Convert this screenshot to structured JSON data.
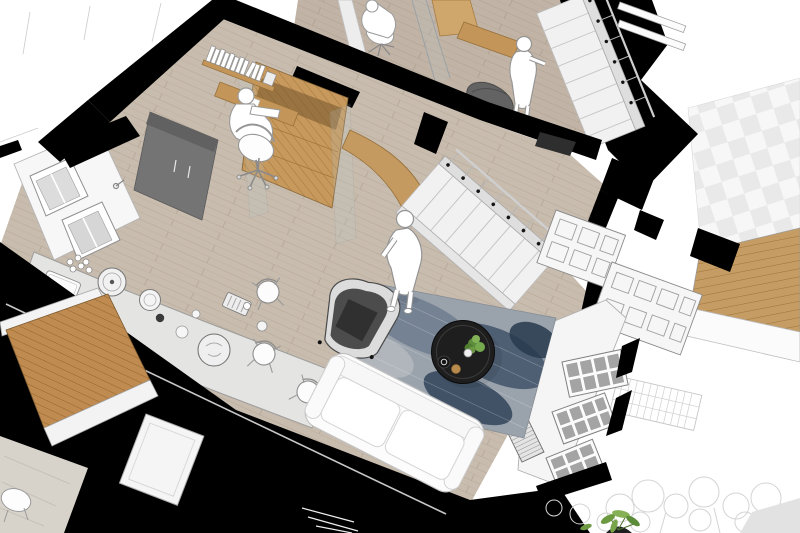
{
  "meta": {
    "label": "Aerial cutaway rendering of a split-level apartment interior, sketch style with black section-cut walls"
  },
  "palette": {
    "background": "#ffffff",
    "cut_walls": "#000000",
    "floor_wood": "#c8bcae",
    "stairwell_wood": "#c7995c",
    "deck_wood": "#bf8b50",
    "counter_gray": "#e4e4e2",
    "cabinet_gray": "#747474",
    "glass_pane_gray": "#a4a4a4",
    "rug_blue_gray": "#46586d",
    "armchair_gray": "#4c4c4c",
    "sofa_white": "#fcfcfc",
    "coffee_table_black": "#1e1e1e",
    "plant_green": "#76a84e",
    "figure_white": "#ffffff",
    "sketch_foliage": "#d4d4d4"
  },
  "scene": {
    "level_upper": [
      "wall desk with seated figure on task chair",
      "glass partition",
      "wood wet-room floor",
      "wall-mounted wood desk",
      "standing figure",
      "gray beanbag chair",
      "upper staircase with thin balusters",
      "white handrail bars over chimney cut"
    ],
    "kitchen": [
      "window wall with two white-framed windows",
      "faucet",
      "tall gray cabinet",
      "tiled gray wall with door",
      "long counter with sink",
      "pots, kettle, cups, dishes, round tray",
      "three dining chairs"
    ],
    "office_nook": [
      "bookshelf with white books",
      "wood desk",
      "seated figure on swivel chair"
    ],
    "stair_hall": [
      "wood-clad stairwell opening with glass balustrade",
      "curved wood panel",
      "main staircase with black baluster caps",
      "standing figure",
      "dark doormat"
    ],
    "living_room": [
      "blue distressed rug",
      "dark gray wingback armchair",
      "round black coffee table with potted plant, cup, bowl, pastry",
      "white two-seat sofa",
      "striped radiator",
      "bay window with gray glazing",
      "black cut edges"
    ],
    "exterior": [
      "balcony wood deck with white rails",
      "lower-level gray floor and white door",
      "white chair on deck",
      "paneled wainscot facade walls",
      "checker roof plane",
      "side wood deck",
      "sketched trellis",
      "sketched gray trees",
      "green shrub",
      "gray ground wedge"
    ]
  },
  "people": [
    {
      "id": "figure-seated-office-nook",
      "pose": "seated at desk"
    },
    {
      "id": "figure-seated-upper-desk",
      "pose": "seated at desk"
    },
    {
      "id": "figure-standing-hall",
      "pose": "standing"
    },
    {
      "id": "figure-standing-upper",
      "pose": "standing"
    }
  ]
}
